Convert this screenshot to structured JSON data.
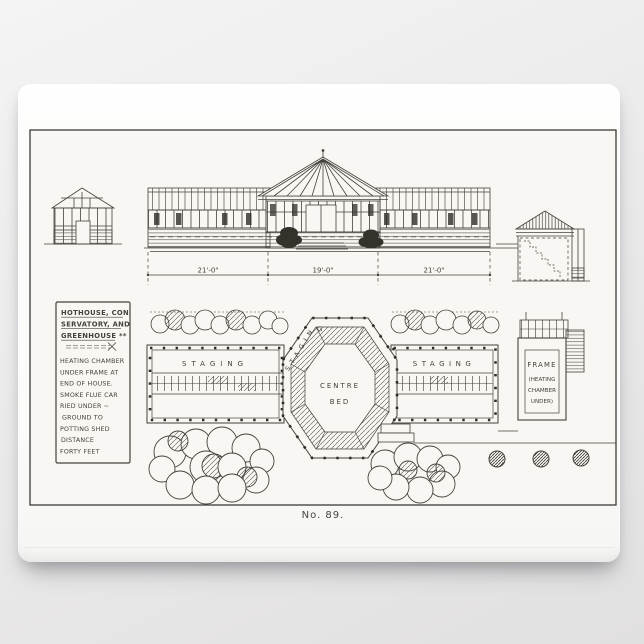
{
  "photo": {
    "background_color": "#ececec",
    "plaque_color": "#fdfdfc",
    "paper_color": "#f8f7f3",
    "ink_color": "#46423b",
    "ink_dark_color": "#2f2c27"
  },
  "caption": "No. 89.",
  "notes_box": {
    "title_lines": [
      "HOTHOUSE, CON",
      "SERVATORY, AND",
      "GREENHOUSE **"
    ],
    "body_lines": [
      "HEATING CHAMBER",
      "UNDER FRAME AT",
      "END OF HOUSE.",
      "SMOKE FLUE CAR",
      "RIED UNDER ~",
      "GROUND TO",
      "POTTING SHED",
      "DISTANCE",
      "FORTY FEET"
    ]
  },
  "dimensions": {
    "left": "21'-0\"",
    "center": "19'-0\"",
    "right": "21'-0\""
  },
  "plan": {
    "left_wing_label": "STAGING",
    "right_wing_label": "STAGING",
    "octagon_arc_label": "STAGING",
    "centre_bed_line1": "CENTRE",
    "centre_bed_line2": "BED",
    "frame_box_lines": [
      "FRAME",
      "(HEATING",
      "CHAMBER",
      "UNDER)"
    ]
  }
}
